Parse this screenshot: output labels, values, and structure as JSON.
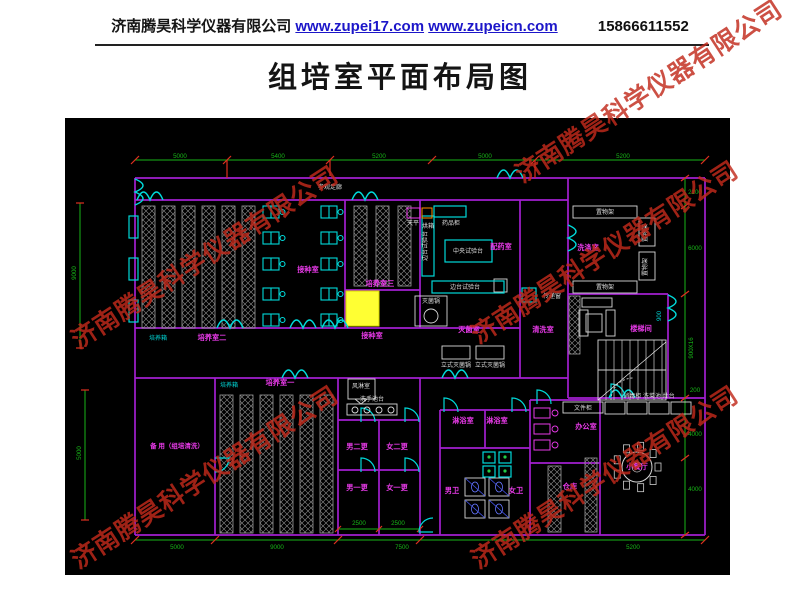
{
  "header": {
    "company": "济南腾昊科学仪器有限公司",
    "link1": "www.zupei17.com",
    "link2": "www.zupeicn.com",
    "phone": "15866611552"
  },
  "title": "组培室平面布局图",
  "watermark": {
    "text": "济南腾昊科学仪器有限公司",
    "color": "#c22a1c",
    "positions": [
      {
        "x": 48,
        "y": 238
      },
      {
        "x": 448,
        "y": 233
      },
      {
        "x": 492,
        "y": 72
      },
      {
        "x": 48,
        "y": 458
      },
      {
        "x": 448,
        "y": 458
      }
    ]
  },
  "colors": {
    "background": "#000000",
    "wall": "#a31fd0",
    "door": "#00d9d9",
    "room_label": "#e83ae8",
    "equipment_label": "#dedede",
    "dimension": "#17b517",
    "tick": "#e03020",
    "rack": "#9a9a9a",
    "highlight": "#ffff33"
  },
  "floorplan": {
    "labels": [
      {
        "t": "参观走廊",
        "x": 265,
        "y": 71,
        "c": "w"
      },
      {
        "t": "接种室",
        "x": 243,
        "y": 154,
        "c": "m"
      },
      {
        "t": "培养室三",
        "x": 315,
        "y": 168,
        "c": "m"
      },
      {
        "t": "培养箱",
        "x": 93,
        "y": 222,
        "c": "cy"
      },
      {
        "t": "培养室二",
        "x": 147,
        "y": 222,
        "c": "m"
      },
      {
        "t": "接种室",
        "x": 307,
        "y": 220,
        "c": "m"
      },
      {
        "t": "配药室",
        "x": 436,
        "y": 131,
        "c": "m"
      },
      {
        "t": "洗涤室",
        "x": 523,
        "y": 132,
        "c": "m"
      },
      {
        "t": "灭菌室",
        "x": 404,
        "y": 214,
        "c": "m"
      },
      {
        "t": "清洗室",
        "x": 478,
        "y": 214,
        "c": "m"
      },
      {
        "t": "楼梯间",
        "x": 576,
        "y": 213,
        "c": "m"
      },
      {
        "t": "培养箱",
        "x": 164,
        "y": 269,
        "c": "cy"
      },
      {
        "t": "培养室一",
        "x": 215,
        "y": 267,
        "c": "m"
      },
      {
        "t": "备 用（组培清洗）",
        "x": 112,
        "y": 330,
        "c": "m",
        "s": 6.5
      },
      {
        "t": "男二更",
        "x": 292,
        "y": 331,
        "c": "m"
      },
      {
        "t": "女二更",
        "x": 332,
        "y": 331,
        "c": "m"
      },
      {
        "t": "男一更",
        "x": 292,
        "y": 372,
        "c": "m"
      },
      {
        "t": "女一更",
        "x": 332,
        "y": 372,
        "c": "m"
      },
      {
        "t": "淋浴室",
        "x": 398,
        "y": 305,
        "c": "m"
      },
      {
        "t": "淋浴室",
        "x": 432,
        "y": 305,
        "c": "m"
      },
      {
        "t": "男卫",
        "x": 387,
        "y": 375,
        "c": "m"
      },
      {
        "t": "女卫",
        "x": 451,
        "y": 375,
        "c": "m"
      },
      {
        "t": "办公室",
        "x": 521,
        "y": 311,
        "c": "m"
      },
      {
        "t": "仓库",
        "x": 505,
        "y": 371,
        "c": "m"
      },
      {
        "t": "小餐厅",
        "x": 572,
        "y": 351,
        "c": "m"
      },
      {
        "t": "天平",
        "x": 348,
        "y": 107,
        "c": "w"
      },
      {
        "t": "烘箱",
        "x": 363,
        "y": 110,
        "c": "w"
      },
      {
        "t": "药品柜",
        "x": 386,
        "y": 107,
        "c": "w"
      },
      {
        "t": "中央试验台",
        "x": 403,
        "y": 135,
        "c": "w"
      },
      {
        "t": "边台试验台",
        "x": 362,
        "y": 128,
        "c": "w",
        "v": true
      },
      {
        "t": "边台试验台",
        "x": 400,
        "y": 171,
        "c": "w"
      },
      {
        "t": "灭菌锅",
        "x": 366,
        "y": 185,
        "c": "w"
      },
      {
        "t": "立式灭菌锅",
        "x": 391,
        "y": 249,
        "c": "w"
      },
      {
        "t": "立式灭菌锅",
        "x": 425,
        "y": 249,
        "c": "w"
      },
      {
        "t": "置物架",
        "x": 540,
        "y": 96,
        "c": "w"
      },
      {
        "t": "置物架",
        "x": 540,
        "y": 171,
        "c": "w"
      },
      {
        "t": "置物架",
        "x": 582,
        "y": 115,
        "c": "w",
        "v": true
      },
      {
        "t": "置物架",
        "x": 582,
        "y": 149,
        "c": "w",
        "v": true
      },
      {
        "t": "风淋室",
        "x": 296,
        "y": 270,
        "c": "w"
      },
      {
        "t": "洗手池台",
        "x": 307,
        "y": 283,
        "c": "w"
      },
      {
        "t": "传递窗",
        "x": 487,
        "y": 180,
        "c": "w"
      },
      {
        "t": "文件柜",
        "x": 518,
        "y": 292,
        "c": "w"
      },
      {
        "t": "消毒柜 洗菜池 灶台",
        "x": 584,
        "y": 280,
        "c": "w"
      },
      {
        "t": "5000",
        "x": 115,
        "y": 40,
        "c": "g"
      },
      {
        "t": "5400",
        "x": 213,
        "y": 40,
        "c": "g"
      },
      {
        "t": "5200",
        "x": 314,
        "y": 40,
        "c": "g"
      },
      {
        "t": "5000",
        "x": 420,
        "y": 40,
        "c": "g"
      },
      {
        "t": "5200",
        "x": 558,
        "y": 40,
        "c": "g"
      },
      {
        "t": "9000",
        "x": 11,
        "y": 155,
        "c": "g",
        "v": true
      },
      {
        "t": "5000",
        "x": 16,
        "y": 335,
        "c": "g",
        "v": true
      },
      {
        "t": "2100",
        "x": 630,
        "y": 76,
        "c": "g"
      },
      {
        "t": "6000",
        "x": 630,
        "y": 132,
        "c": "g"
      },
      {
        "t": "900X16",
        "x": 628,
        "y": 230,
        "c": "g",
        "v": true
      },
      {
        "t": "200",
        "x": 630,
        "y": 274,
        "c": "g"
      },
      {
        "t": "4000",
        "x": 630,
        "y": 318,
        "c": "g"
      },
      {
        "t": "4000",
        "x": 630,
        "y": 373,
        "c": "g"
      },
      {
        "t": "900",
        "x": 596,
        "y": 198,
        "c": "cy",
        "v": true
      },
      {
        "t": "2500",
        "x": 294,
        "y": 407,
        "c": "g"
      },
      {
        "t": "2500",
        "x": 333,
        "y": 407,
        "c": "g"
      },
      {
        "t": "5000",
        "x": 112,
        "y": 431,
        "c": "g"
      },
      {
        "t": "9000",
        "x": 212,
        "y": 431,
        "c": "g"
      },
      {
        "t": "7500",
        "x": 337,
        "y": 431,
        "c": "g"
      },
      {
        "t": "5200",
        "x": 568,
        "y": 431,
        "c": "g"
      }
    ]
  }
}
